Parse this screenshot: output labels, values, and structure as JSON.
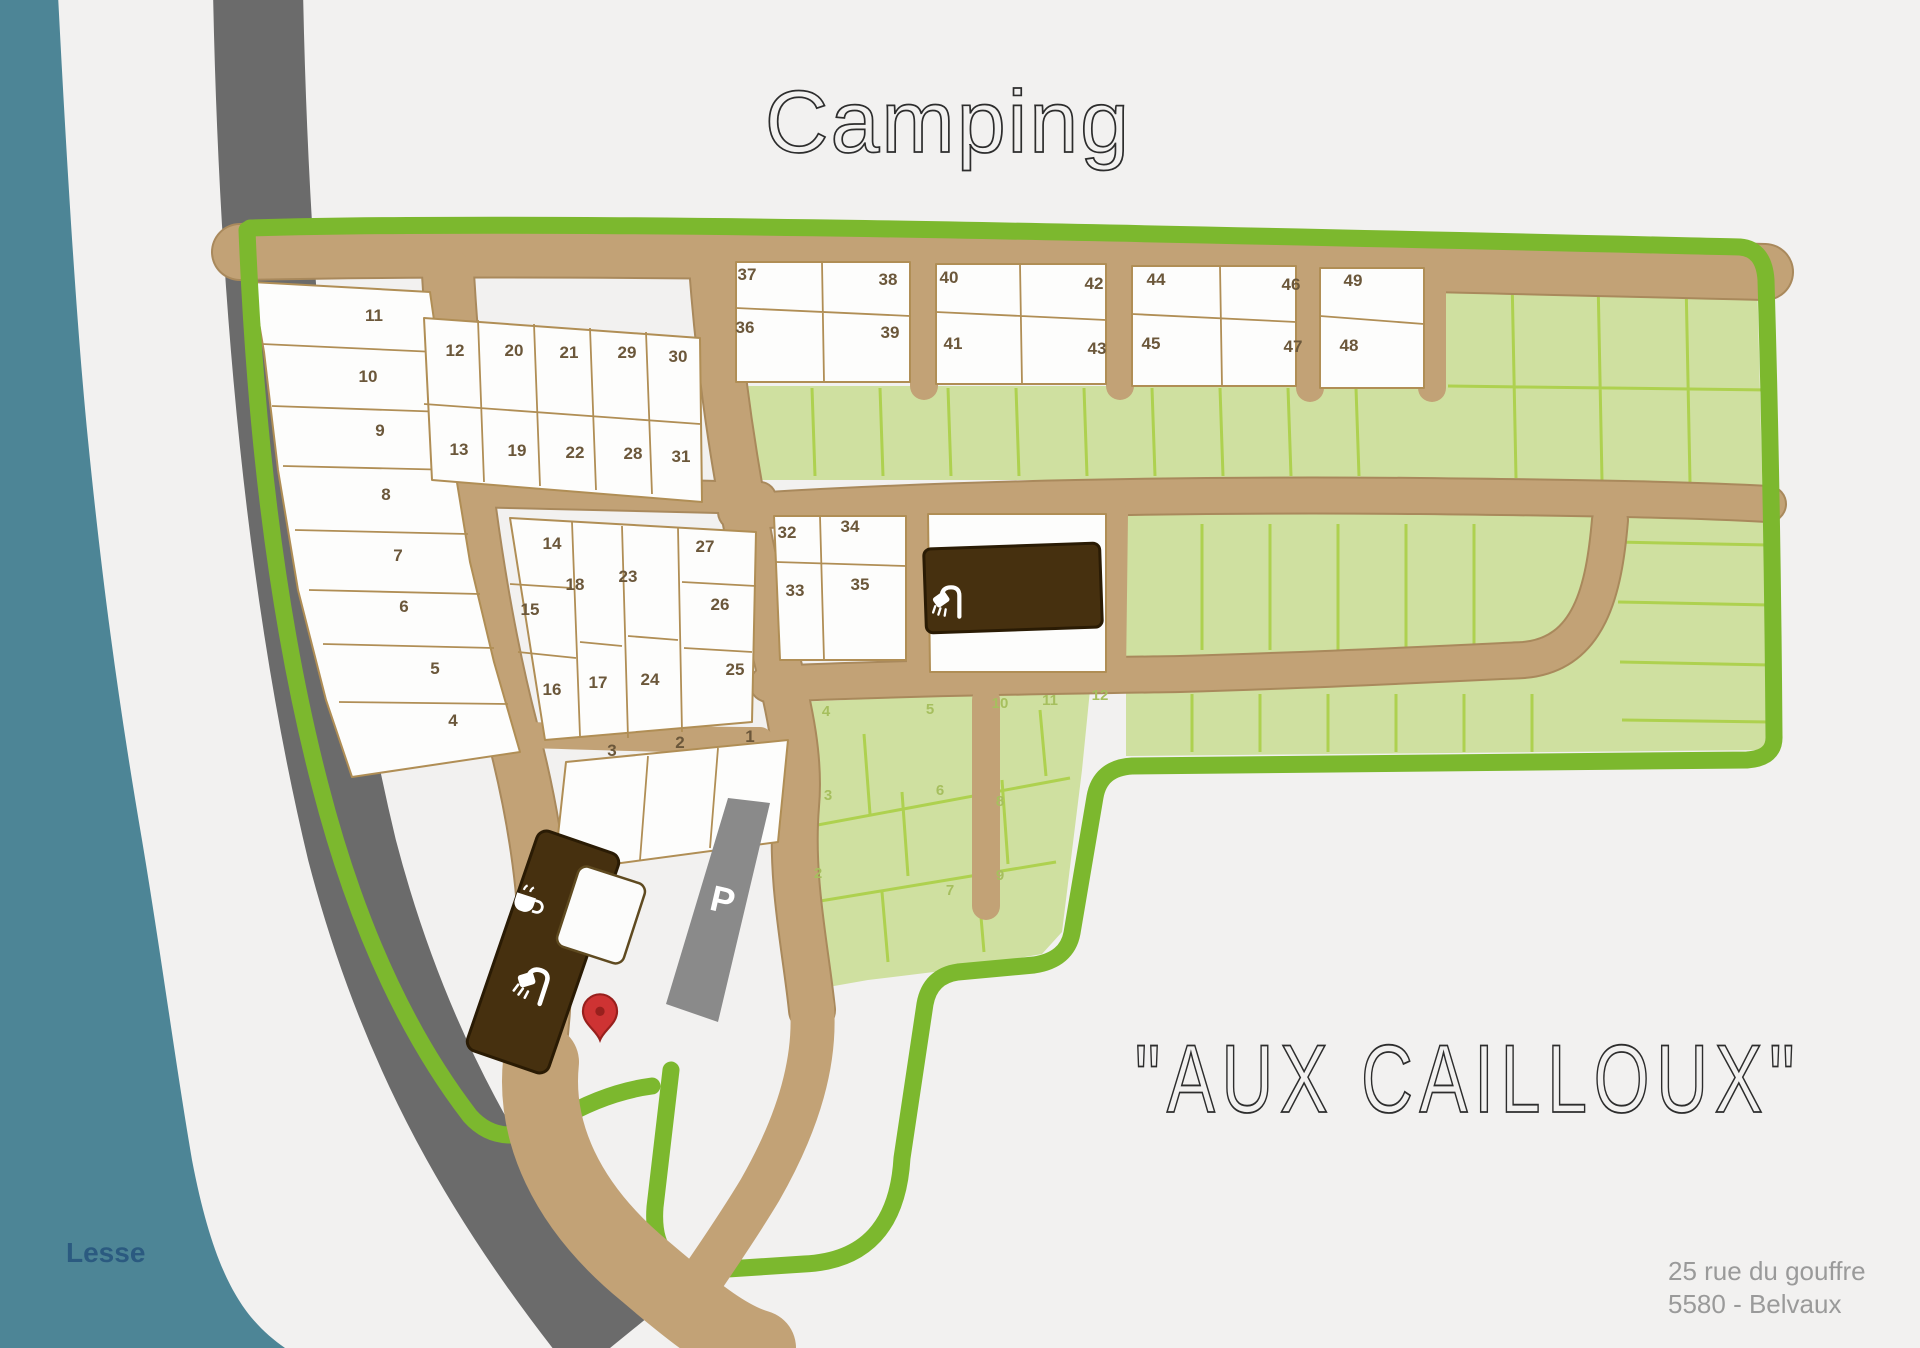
{
  "title": "Camping",
  "site_name": "\"AUX  CAILLOUX\"",
  "address": {
    "line1": "25 rue du gouffre",
    "line2": "5580 - Belvaux"
  },
  "river_label": "Lesse",
  "parking_label": "P",
  "colors": {
    "background": "#f2f1f0",
    "river": "#4d8596",
    "road": "#6b6b6b",
    "path": "#c2a276",
    "green_border": "#7cb82e",
    "green_fill": "#cfe0a0",
    "green_line": "#aed14f",
    "plot_number": "#6b573a",
    "building": "#46300f",
    "pin": "#ce3333",
    "parking": "#8a8a8a"
  },
  "white_plots": [
    {
      "n": "1",
      "x": 750,
      "y": 742
    },
    {
      "n": "2",
      "x": 680,
      "y": 748
    },
    {
      "n": "3",
      "x": 612,
      "y": 756
    },
    {
      "n": "4",
      "x": 453,
      "y": 726
    },
    {
      "n": "5",
      "x": 435,
      "y": 674
    },
    {
      "n": "6",
      "x": 404,
      "y": 612
    },
    {
      "n": "7",
      "x": 398,
      "y": 561
    },
    {
      "n": "8",
      "x": 386,
      "y": 500
    },
    {
      "n": "9",
      "x": 380,
      "y": 436
    },
    {
      "n": "10",
      "x": 368,
      "y": 382
    },
    {
      "n": "11",
      "x": 374,
      "y": 321
    },
    {
      "n": "12",
      "x": 455,
      "y": 356
    },
    {
      "n": "13",
      "x": 459,
      "y": 455
    },
    {
      "n": "14",
      "x": 552,
      "y": 549
    },
    {
      "n": "15",
      "x": 530,
      "y": 615
    },
    {
      "n": "16",
      "x": 552,
      "y": 695
    },
    {
      "n": "17",
      "x": 598,
      "y": 688
    },
    {
      "n": "18",
      "x": 575,
      "y": 590
    },
    {
      "n": "19",
      "x": 517,
      "y": 456
    },
    {
      "n": "20",
      "x": 514,
      "y": 356
    },
    {
      "n": "21",
      "x": 569,
      "y": 358
    },
    {
      "n": "22",
      "x": 575,
      "y": 458
    },
    {
      "n": "23",
      "x": 628,
      "y": 582
    },
    {
      "n": "24",
      "x": 650,
      "y": 685
    },
    {
      "n": "25",
      "x": 735,
      "y": 675
    },
    {
      "n": "26",
      "x": 720,
      "y": 610
    },
    {
      "n": "27",
      "x": 705,
      "y": 552
    },
    {
      "n": "28",
      "x": 633,
      "y": 459
    },
    {
      "n": "29",
      "x": 627,
      "y": 358
    },
    {
      "n": "30",
      "x": 678,
      "y": 362
    },
    {
      "n": "31",
      "x": 681,
      "y": 462
    },
    {
      "n": "32",
      "x": 787,
      "y": 538
    },
    {
      "n": "33",
      "x": 795,
      "y": 596
    },
    {
      "n": "34",
      "x": 850,
      "y": 532
    },
    {
      "n": "35",
      "x": 860,
      "y": 590
    },
    {
      "n": "36",
      "x": 745,
      "y": 333
    },
    {
      "n": "37",
      "x": 747,
      "y": 280
    },
    {
      "n": "38",
      "x": 888,
      "y": 285
    },
    {
      "n": "39",
      "x": 890,
      "y": 338
    },
    {
      "n": "40",
      "x": 949,
      "y": 283
    },
    {
      "n": "41",
      "x": 953,
      "y": 349
    },
    {
      "n": "42",
      "x": 1094,
      "y": 289
    },
    {
      "n": "43",
      "x": 1097,
      "y": 354
    },
    {
      "n": "44",
      "x": 1156,
      "y": 285
    },
    {
      "n": "45",
      "x": 1151,
      "y": 349
    },
    {
      "n": "46",
      "x": 1291,
      "y": 290
    },
    {
      "n": "47",
      "x": 1293,
      "y": 352
    },
    {
      "n": "48",
      "x": 1349,
      "y": 351
    },
    {
      "n": "49",
      "x": 1353,
      "y": 286
    }
  ],
  "green_plots": [
    {
      "n": "2",
      "x": 818,
      "y": 878
    },
    {
      "n": "3",
      "x": 828,
      "y": 800
    },
    {
      "n": "4",
      "x": 826,
      "y": 716
    },
    {
      "n": "5",
      "x": 930,
      "y": 714
    },
    {
      "n": "6",
      "x": 940,
      "y": 795
    },
    {
      "n": "7",
      "x": 950,
      "y": 895
    },
    {
      "n": "8",
      "x": 1000,
      "y": 806
    },
    {
      "n": "9",
      "x": 1000,
      "y": 880
    },
    {
      "n": "10",
      "x": 1000,
      "y": 708
    },
    {
      "n": "11",
      "x": 1050,
      "y": 705
    },
    {
      "n": "12",
      "x": 1100,
      "y": 700
    }
  ]
}
